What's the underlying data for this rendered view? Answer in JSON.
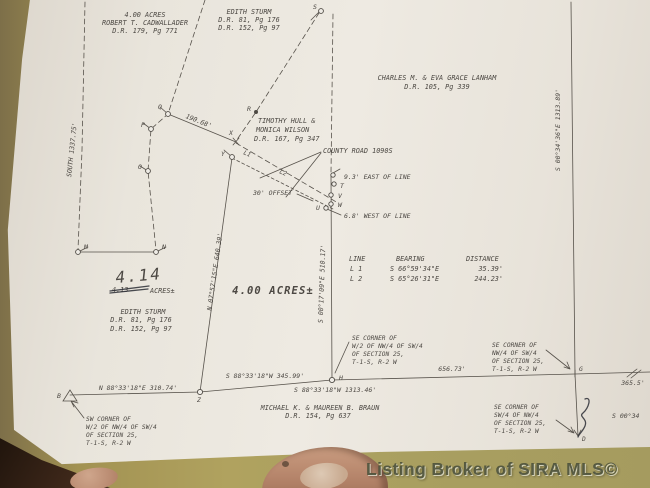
{
  "photo": {
    "watermark": "Listing Broker of SIRA MLS©"
  },
  "plat": {
    "owners": {
      "cadwallader": {
        "line1": "4.00 ACRES",
        "line2": "ROBERT T. CADWALLADER",
        "line3": "D.R. 179, Pg 771"
      },
      "sturm_north": {
        "line1": "EDITH STURM",
        "line2": "D.R. 81, Pg 176",
        "line3": "D.R. 152, Pg 97"
      },
      "lanham": {
        "line1": "CHARLES M. & EVA GRACE LANHAM",
        "line2": "D.R. 105, Pg 339"
      },
      "hull": {
        "line1": "TIMOTHY HULL &",
        "line2": "MONICA WILSON",
        "line3": "D.R. 167, Pg 347"
      },
      "sturm_west": {
        "line1": "EDITH STURM",
        "line2": "D.R. 81, Pg 176",
        "line3": "D.R. 152, Pg 97"
      },
      "braun": {
        "line1": "MICHAEL K. & MAUREEN B. BRAUN",
        "line2": "D.R. 154, Pg 637"
      }
    },
    "road": {
      "label": "COUNTY ROAD 1090S",
      "offset": "30' OFFSET",
      "east": "9.3' EAST OF LINE",
      "west": "6.8' WEST OF LINE",
      "tie_dist": "190.68'",
      "l1": "L1",
      "l2": "L2"
    },
    "parcel": {
      "area": "4.00 ACRES±",
      "west_line": "N 07°57'15\"E   640.39'",
      "east_line": "S 00°17'09\"E   510.17'"
    },
    "revision": {
      "new_area": "4.14",
      "old_area": "4.13",
      "unit": "ACRES±"
    },
    "boundaries": {
      "south_label": "SOUTH  1337.75'",
      "east_label": "S 00°34'36\"E   1313.89'",
      "b_z": "N 88°33'18\"E   310.74'",
      "z_h": "S 88°33'18\"W  345.99'",
      "h_row": "S 88°33'18\"W  1313.46'",
      "h_g": "656.73'",
      "g_e": "365.5'",
      "s0034": "S 00°34"
    },
    "line_table": {
      "headers": [
        "LINE",
        "BEARING",
        "DISTANCE"
      ],
      "rows": [
        [
          "L 1",
          "S 66°59'34\"E",
          "35.39'"
        ],
        [
          "L 2",
          "S 65°26'31\"E",
          "244.23'"
        ]
      ]
    },
    "corners": {
      "sw": [
        "SW CORNER OF",
        "W/2 OF NW/4 OF SW/4",
        "OF SECTION 25,",
        "T-1-S, R-2 W"
      ],
      "se_w2": [
        "SE CORNER OF",
        "W/2 OF NW/4 OF SW/4",
        "OF SECTION 25,",
        "T-1-S, R-2 W"
      ],
      "se_nw4": [
        "SE CORNER OF",
        "NW/4 OF SW/4",
        "OF SECTION 25,",
        "T-1-S, R-2 W"
      ],
      "se_sw4": [
        "SE CORNER OF",
        "SW/4 OF NW/4",
        "OF SECTION 25,",
        "T-1-S, R-2 W"
      ]
    },
    "points": {
      "S": "S",
      "R": "R",
      "Q": "Q",
      "P": "P",
      "O": "O",
      "X": "X",
      "Y": "Y",
      "M": "M",
      "N": "N",
      "T": "T",
      "V": "V",
      "W": "W",
      "U": "U",
      "B": "B",
      "Z": "Z",
      "H": "H",
      "G": "G",
      "D": "D"
    }
  }
}
